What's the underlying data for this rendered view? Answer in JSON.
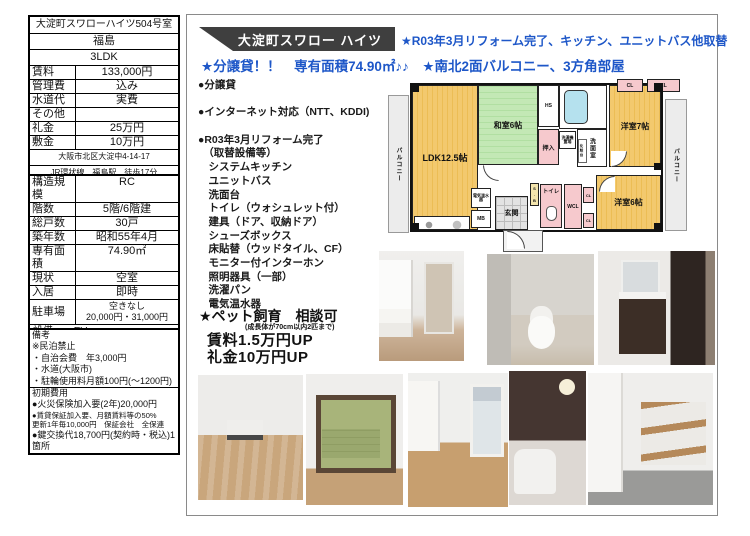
{
  "colors": {
    "accent_blue": "#1e57c8",
    "banner_bg": "#3f3f3f",
    "plan_tan": "#f2c46a",
    "plan_green": "#bce4ae",
    "plan_pink": "#f6c9cd"
  },
  "left_panel": {
    "property_name": "大淀町スワローハイツ504号室",
    "area": "福島",
    "layout": "3LDK",
    "price_rows": [
      {
        "label": "賃料",
        "value": "133,000円"
      },
      {
        "label": "管理費",
        "value": "込み"
      },
      {
        "label": "水道代",
        "value": "実費"
      },
      {
        "label": "その他",
        "value": ""
      },
      {
        "label": "礼金",
        "value": "25万円"
      },
      {
        "label": "敷金",
        "value": "10万円"
      }
    ],
    "address": "大阪市北区大淀中4-14-17",
    "access": "JR環状線　福島駅　徒歩17分",
    "building_rows": [
      {
        "label": "構造規模",
        "value": "RC"
      },
      {
        "label": "階数",
        "value": "5階/6階建"
      },
      {
        "label": "総戸数",
        "value": "30戸"
      },
      {
        "label": "築年数",
        "value": "昭和55年4月"
      },
      {
        "label": "専有面積",
        "value": "74.90㎡"
      },
      {
        "label": "現状",
        "value": "空室"
      },
      {
        "label": "入居",
        "value": "即時"
      }
    ],
    "parking_label": "駐車場",
    "parking_line1": "空きなし",
    "parking_line2": "20,000円・31,000円",
    "facility_label": "設備",
    "facility_value": "EV",
    "utilities": "電気、上下水道、都市ガス",
    "remarks_title": "備考",
    "remarks": [
      "※民泊禁止",
      "・自治会費　年3,000円",
      "・水道(大阪市)",
      "・駐輪使用料月額100円(〜1200円)"
    ],
    "initial_title": "初期費用",
    "initial": [
      "●火災保険加入要(2年)20,000円",
      "●賃貸保証加入要、月額賃料等の50%",
      "更新1年毎10,000円　保証会社　全保連",
      "●鍵交換代18,700円(契約時・税込)1箇所"
    ]
  },
  "right_panel": {
    "banner_title": "大淀町スワロー ハイツ",
    "headline1": "★R03年3月リフォーム完了、キッチン、ユニットバス他取替",
    "headline2": "★分譲貸！！　専有面積74.90㎡♪♪　★南北2面バルコニー、3方角部屋",
    "features": [
      "●分譲貸",
      "",
      "●インターネット対応（NTT、KDDI)",
      "",
      "●R03年3月リフォーム完了",
      "　（取替設備等）",
      "　システムキッチン",
      "　ユニットバス",
      "　洗面台",
      "　トイレ（ウォシュレット付）",
      "　建具（ドア、収納ドア）",
      "　シューズボックス",
      "　床貼替（ウッドタイル、CF）",
      "　モニター付インターホン",
      "　照明器具（一部）",
      "　洗濯パン",
      "　電気温水器"
    ],
    "pet_title": "★ペット飼育　相談可",
    "pet_note": "(成長体が70cm以内2匹まで)",
    "pet_line1": "賃料1.5万円UP",
    "pet_line2": "礼金10万円UP",
    "floorplan": {
      "balcony_left": "バルコニー",
      "balcony_right": "バルコニー",
      "ldk": "LDK12.5帖",
      "washitsu": "和室6帖",
      "oshiire": "押入",
      "hs": "HS",
      "washer": "洗濯機置場",
      "senmen": "洗面室",
      "vanity": "化粧台",
      "yoshitsu7": "洋室7帖",
      "cl": "CL",
      "yoshitsu6": "洋室6帖",
      "wcl": "WCL",
      "toilet": "トイレ",
      "genkan": "玄関",
      "mb": "MB",
      "sb": "S.B",
      "boiler": "電気温水器"
    }
  }
}
